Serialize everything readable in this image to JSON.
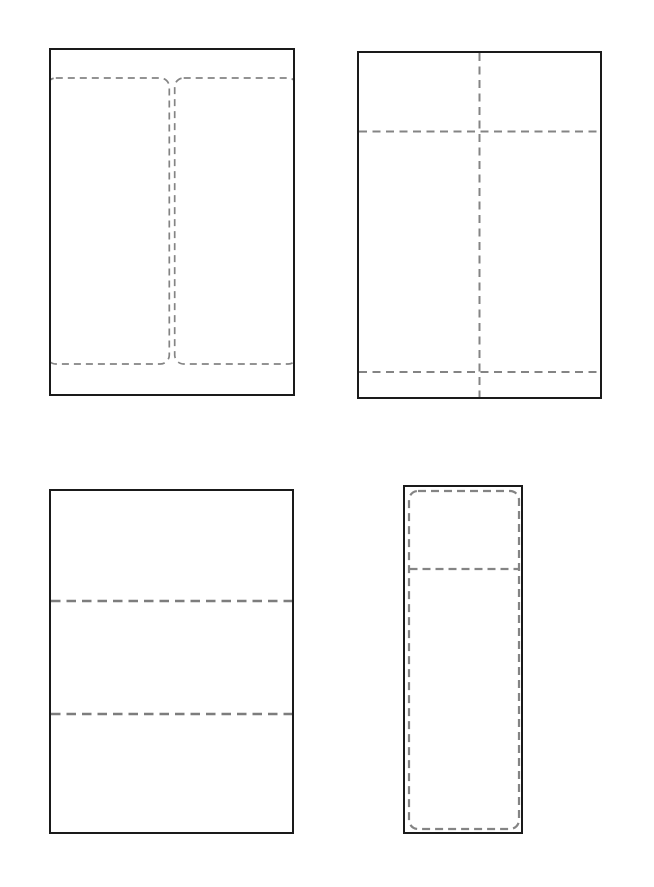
{
  "colors": {
    "background": "#ffffff",
    "panel_border": "#1a1a1a",
    "dash_line": "#848484",
    "fold_dash_line": "#7d7d7d"
  },
  "panels": [
    {
      "name": "two-label-sheet",
      "kind": "portrait-sheet-with-two-vertical-rounded-label-outlines"
    },
    {
      "name": "cross-fold-sheet",
      "kind": "portrait-sheet-with-center-vertical-and-two-horizontal-fold-lines"
    },
    {
      "name": "tri-fold-sheet",
      "kind": "portrait-sheet-with-two-horizontal-tri-fold-lines"
    },
    {
      "name": "single-label-sheet",
      "kind": "narrow-sheet-with-rounded-label-outline-and-top-divider-line"
    }
  ]
}
